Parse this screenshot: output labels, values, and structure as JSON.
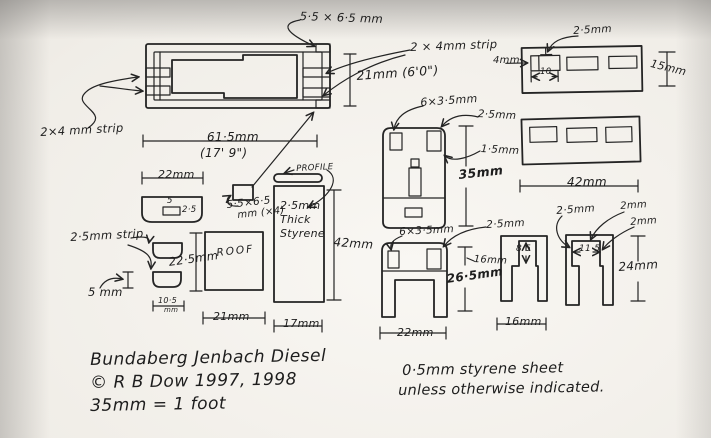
{
  "colors": {
    "paper": "#f0ede7",
    "ink": "#242424"
  },
  "title_block": {
    "line1": "Bundaberg Jenbach Diesel",
    "line2": "© R B Dow  1997, 1998",
    "line3": "35mm = 1 foot"
  },
  "note": {
    "line1": "0·5mm styrene sheet",
    "line2": "unless otherwise indicated."
  },
  "chassis": {
    "pad_size": "5·5 × 6·5 mm",
    "strip_right": "2 × 4mm strip",
    "height": "21mm (6'0\")",
    "strip_left": "2×4 mm strip",
    "length": "61·5mm",
    "length_ft": "(17' 9\")"
  },
  "roof_end": {
    "width": "22mm",
    "block_top": "5",
    "block_side": "2·5"
  },
  "pad": {
    "line1": "5·5×6·5",
    "line2": "mm (×4)"
  },
  "profile": {
    "tag": "PROFILE",
    "thick1": "2·5mm",
    "thick2": "Thick",
    "thick3": "Styrene",
    "height": "42mm",
    "width": "17mm"
  },
  "roof": {
    "strip": "2·5mm strip",
    "height": "22·5mm",
    "label": "ROOF",
    "width": "21mm",
    "small_width": "10·5",
    "small_width_unit": "mm",
    "five": "5 mm"
  },
  "cab_side": {
    "window": "6×3·5mm",
    "corner": "2·5mm",
    "edge": "1·5mm",
    "height": "35mm"
  },
  "grille": {
    "corner": "2·5mm",
    "left": "4mm",
    "window_width": "10",
    "height": "15mm"
  },
  "window_panel": {
    "width": "42mm"
  },
  "cab_end": {
    "window": "6×3·5mm",
    "corner": "2·5mm",
    "mid": "16mm",
    "height": "26·5mm",
    "width": "22mm"
  },
  "u_piece1": {
    "notch": "8·5",
    "width": "16mm"
  },
  "u_piece2": {
    "corner": "2·5mm",
    "wall_top": "2mm",
    "wall_side": "2mm",
    "notch": "11·5",
    "height": "24mm"
  }
}
